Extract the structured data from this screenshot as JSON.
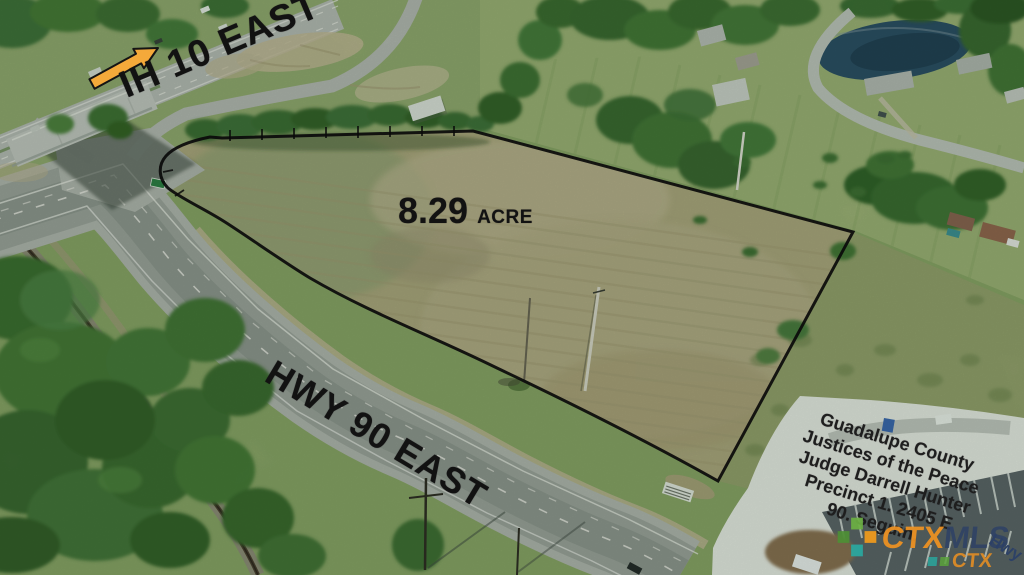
{
  "annotations": {
    "highway_top_label": "IH 10 EAST",
    "acreage": {
      "value": "8.29",
      "unit": "ACRE"
    },
    "highway_bottom_label": "HWY 90 EAST"
  },
  "sign": {
    "lines": [
      "Guadalupe County",
      "Justices of the Peace",
      "Judge Darrell Hunter",
      "Precinct 1. 2405 E",
      "90. Seguin."
    ],
    "partial_fragment": "Hwy"
  },
  "watermark": {
    "ctx": "CTX",
    "mls": "MLS",
    "ctx_small": "CTX"
  },
  "colors": {
    "annotation_text": "#121212",
    "arrow_fill": "#f4a93a",
    "boundary": "#0a0a0a",
    "sign_text": "#1e1e1e",
    "watermark_ctx": "#ef9222",
    "watermark_mls": "#2d4166",
    "watermark_teal": "#2aa79e",
    "watermark_green": "#5aa33b"
  }
}
